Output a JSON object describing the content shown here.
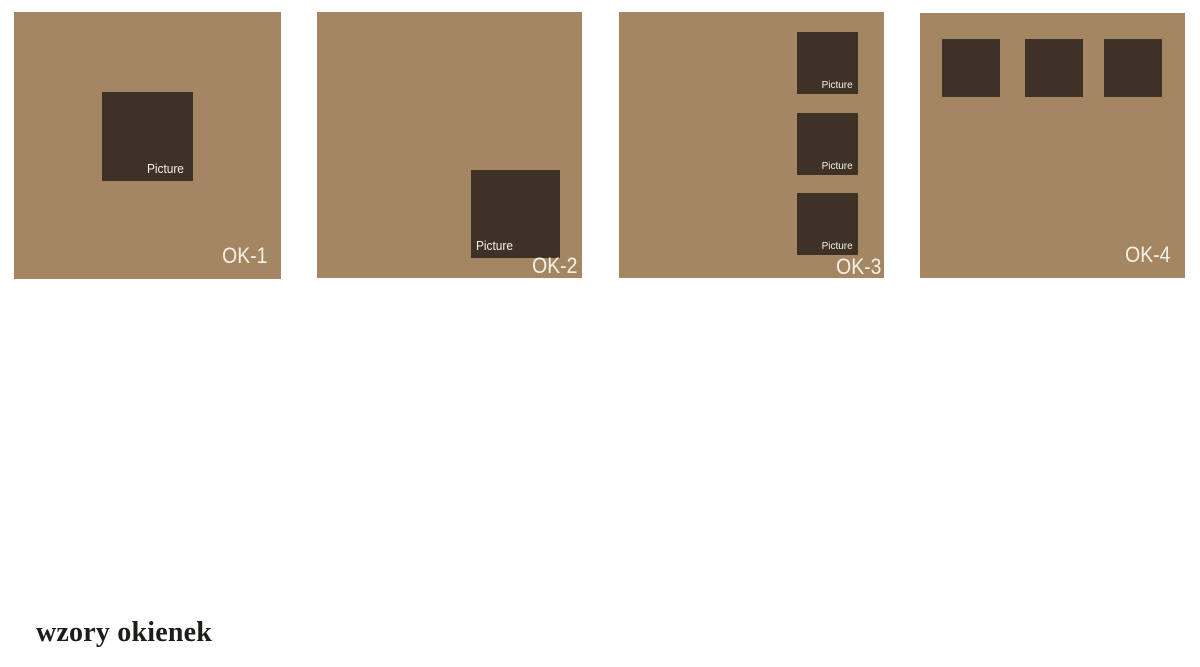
{
  "title": {
    "text": "wzory okienek"
  },
  "colors": {
    "background": "#ffffff",
    "panel": "#a48662",
    "window": "#3e3226",
    "panel_label": "#f6f1e6",
    "picture_label": "#f3efe4",
    "title": "#1f1d1a"
  },
  "panels": [
    {
      "label": "OK-1",
      "windows": [
        {
          "label": "Picture"
        }
      ]
    },
    {
      "label": "OK-2",
      "windows": [
        {
          "label": "Picture"
        }
      ]
    },
    {
      "label": "OK-3",
      "windows": [
        {
          "label": "Picture"
        },
        {
          "label": "Picture"
        },
        {
          "label": "Picture"
        }
      ]
    },
    {
      "label": "OK-4",
      "windows": [
        {},
        {},
        {}
      ]
    }
  ]
}
